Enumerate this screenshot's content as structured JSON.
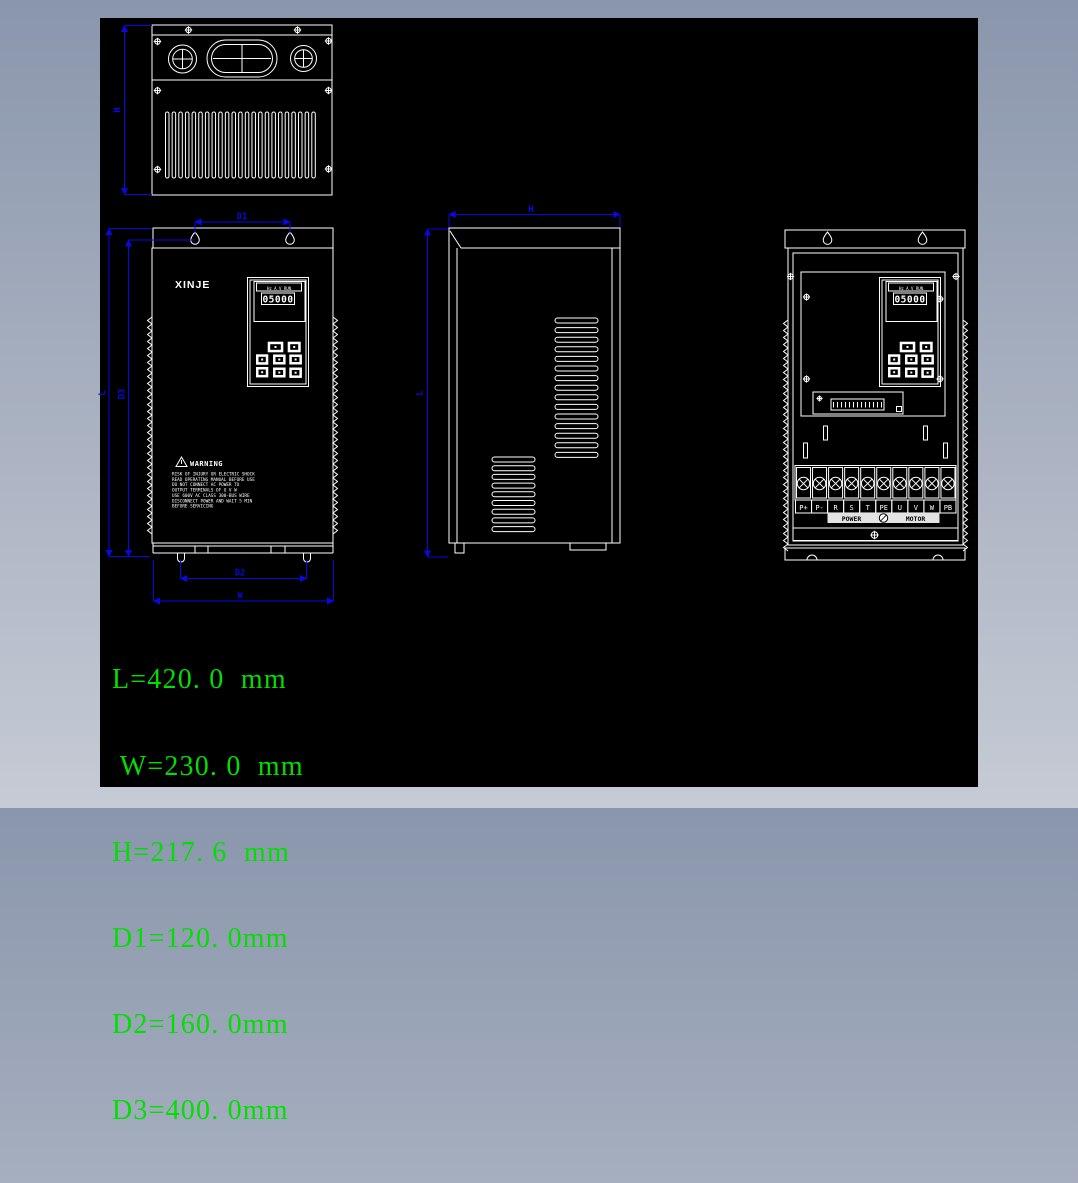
{
  "palette": {
    "frame_top": "#8a96ac",
    "frame_bottom": "#c6cbd5",
    "canvas_bg": "#000000",
    "drawing_line": "#ffffff",
    "dimension_blue": "#0808e8",
    "readout_green": "#00e000"
  },
  "readout": {
    "lines": [
      "L=420. 0  mm",
      " W=230. 0  mm",
      "H=217. 6  mm",
      "D1=120. 0mm",
      "D2=160. 0mm",
      "D3=400. 0mm"
    ]
  },
  "top_view": {
    "dim_label_h": "H"
  },
  "front_view": {
    "brand": "XINJE",
    "display_value": "05000",
    "indicator_labels": "Hz A V RUN",
    "warning": {
      "title": "WARNING",
      "lines": [
        "RISK OF INJURY OR ELECTRIC SHOCK",
        "READ OPERATING MANUAL BEFORE USE",
        "DO NOT CONNECT AC POWER TO",
        "OUTPUT TERMINALS OF U V W",
        "USE 600V AC CLASS 300-BUS WIRE",
        "DISCONNECT POWER AND WAIT 5 MIN",
        "BEFORE SERVICING"
      ]
    },
    "dims": {
      "d1": "D1",
      "l": "L",
      "d3": "D3",
      "d2": "D2",
      "w": "W"
    }
  },
  "side_view": {
    "dims": {
      "h": "H",
      "l": "L"
    }
  },
  "rear_view": {
    "display_value": "05000",
    "indicator_labels": "Hz A V RUN",
    "terminals": [
      "P+",
      "P-",
      "R",
      "S",
      "T",
      "PE",
      "U",
      "V",
      "W",
      "PB"
    ],
    "power_label": "POWER",
    "motor_label": "MOTOR"
  }
}
